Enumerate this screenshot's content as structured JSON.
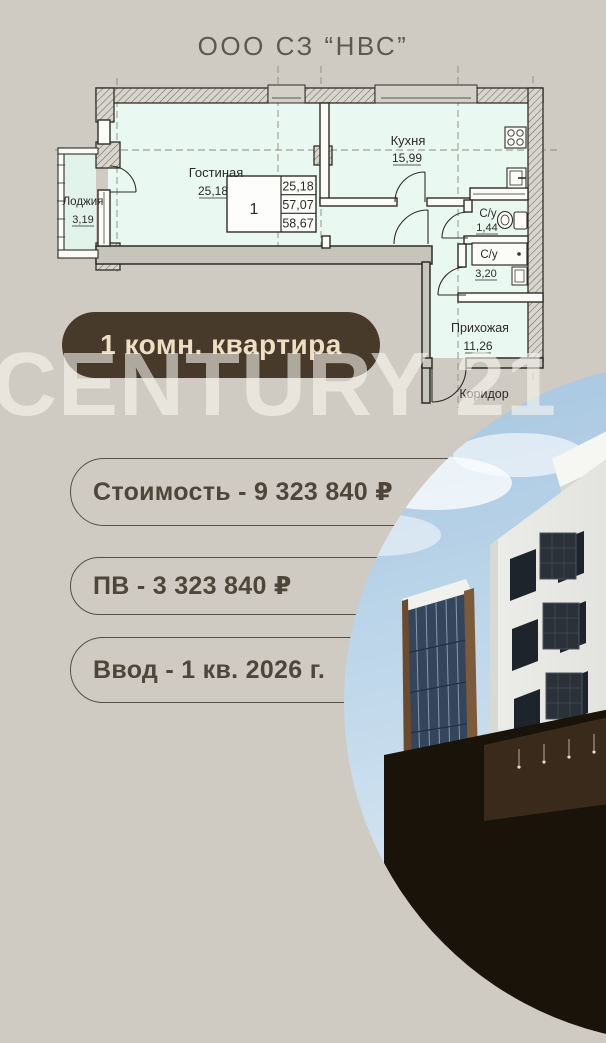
{
  "header": {
    "title": "ООО СЗ “НВС”"
  },
  "plan": {
    "rooms": {
      "living": {
        "label": "Гостиная",
        "area": "25,18"
      },
      "kitchen": {
        "label": "Кухня",
        "area": "15,99"
      },
      "loggia": {
        "label": "Лоджия",
        "area": "3,19"
      },
      "bath_small": {
        "label": "С/у",
        "area": "1,44"
      },
      "bath_big": {
        "label": "С/у",
        "area": "3,20"
      },
      "hallway": {
        "label": "Прихожая",
        "area": "11,26"
      },
      "corridor": {
        "label": "Коридор"
      }
    },
    "area_table": {
      "unit": "1",
      "rows": [
        "25,18",
        "57,07",
        "58,67"
      ]
    }
  },
  "badge": {
    "label": "1 комн. квартира"
  },
  "watermark": {
    "text": "CENTURY 21"
  },
  "details": {
    "price": "Стоимость - 9 323 840 ₽",
    "down_payment": "ПВ - 3 323 840 ₽",
    "completion": "Ввод - 1 кв. 2026 г."
  },
  "colors": {
    "background": "#cfcbc2",
    "room_fill": "#e9f8f1",
    "badge_bg": "#483a2b",
    "badge_text": "#eddfc4",
    "pill_text": "#4e463a",
    "watermark": "#f8f5ee"
  }
}
